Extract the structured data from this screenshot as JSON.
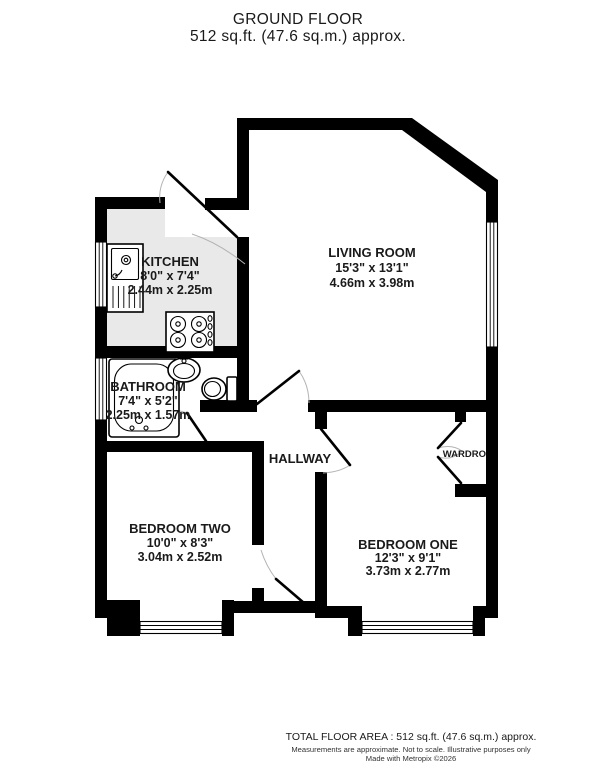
{
  "title": {
    "line1": "GROUND FLOOR",
    "line2": "512 sq.ft. (47.6 sq.m.) approx."
  },
  "rooms": {
    "kitchen": {
      "name": "KITCHEN",
      "imperial": "8'0\" x 7'4\"",
      "metric": "2.44m x 2.25m"
    },
    "living_room": {
      "name": "LIVING ROOM",
      "imperial": "15'3\" x 13'1\"",
      "metric": "4.66m x 3.98m"
    },
    "bathroom": {
      "name": "BATHROOM",
      "imperial": "7'4\" x 5'2\"",
      "metric": "2.25m x 1.57m"
    },
    "hallway": {
      "name": "HALLWAY"
    },
    "bedroom_two": {
      "name": "BEDROOM TWO",
      "imperial": "10'0\" x 8'3\"",
      "metric": "3.04m x 2.52m"
    },
    "bedroom_one": {
      "name": "BEDROOM ONE",
      "imperial": "12'3\" x 9'1\"",
      "metric": "3.73m x 2.77m"
    },
    "wardrobe": {
      "name": "WARDRO"
    }
  },
  "footer": {
    "line1": "TOTAL FLOOR AREA : 512 sq.ft. (47.6 sq.m.) approx.",
    "line2": "Measurements are approximate.  Not to scale.  Illustrative purposes only",
    "line3": "Made with Metropix ©2026"
  },
  "colors": {
    "wall": "#000000",
    "kitchen_floor": "#e9e9e9",
    "door_arc": "#b3b3b3",
    "text": "#1a1a1a"
  }
}
